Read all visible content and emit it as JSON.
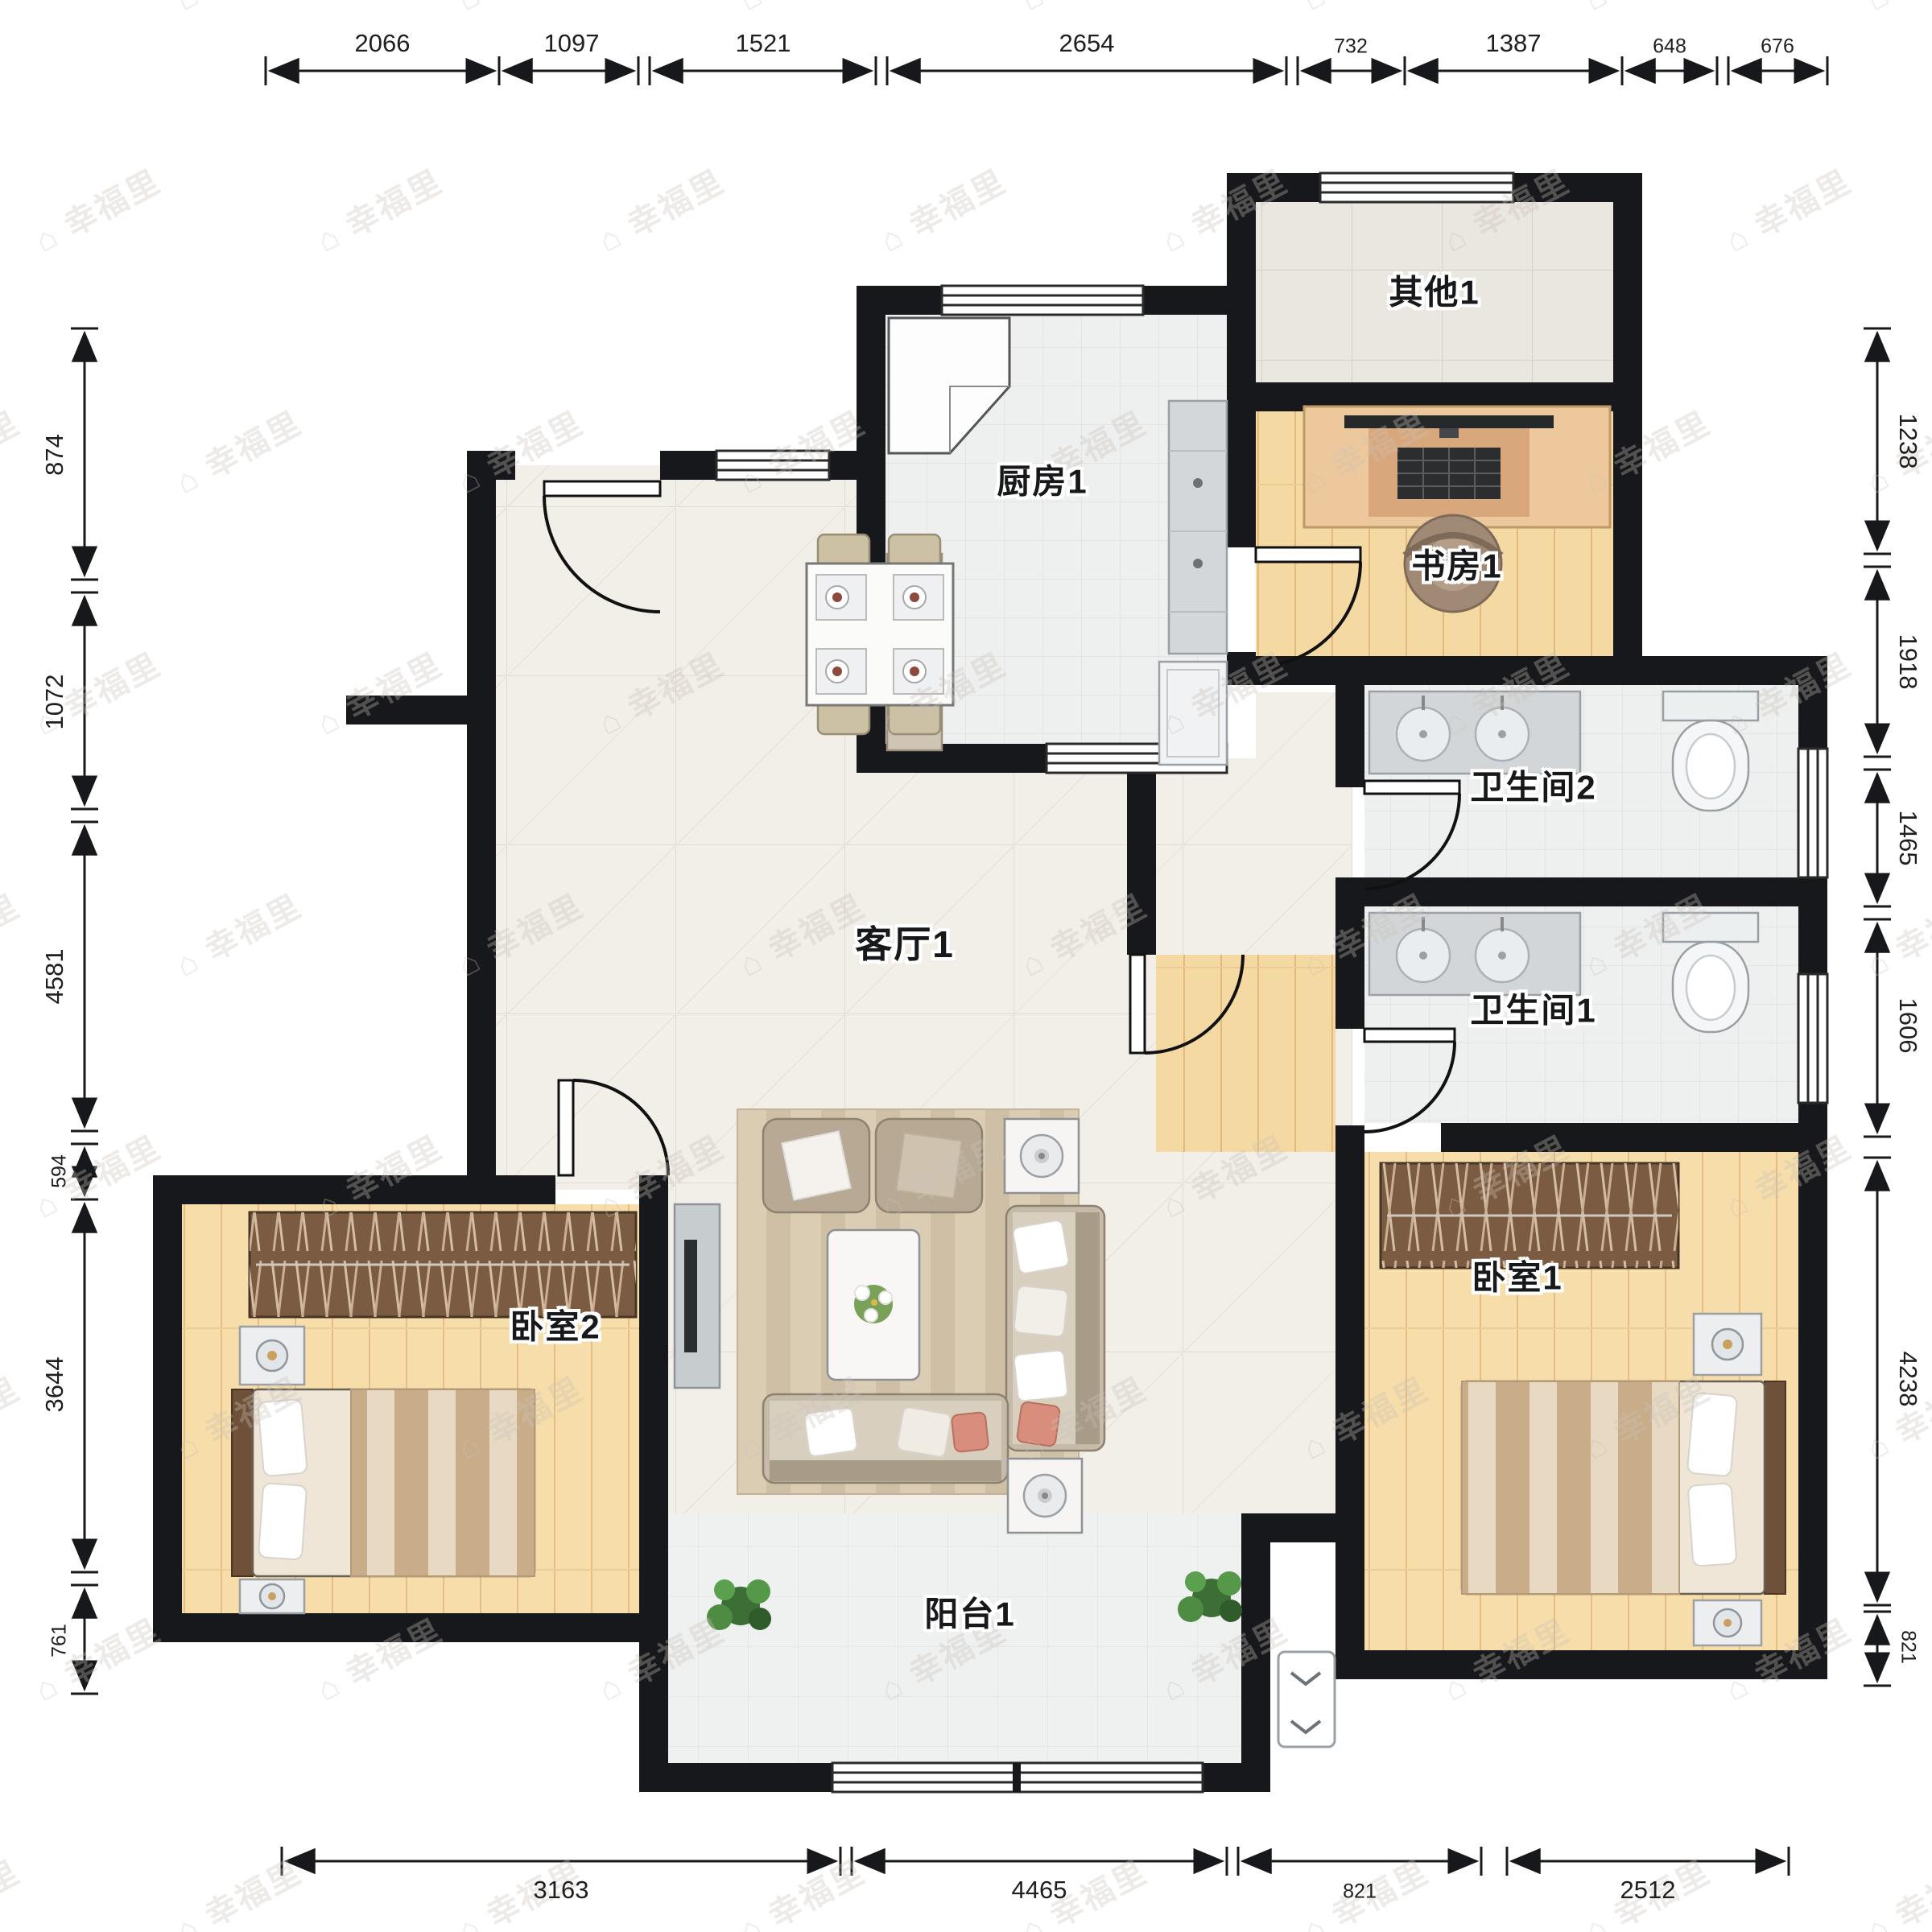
{
  "watermark": {
    "text": "幸福里",
    "icon": "house-icon"
  },
  "rooms": [
    {
      "id": "qita1",
      "label": "其他1"
    },
    {
      "id": "chufang1",
      "label": "厨房1"
    },
    {
      "id": "shufang1",
      "label": "书房1"
    },
    {
      "id": "weishengjian2",
      "label": "卫生间2"
    },
    {
      "id": "weishengjian1",
      "label": "卫生间1"
    },
    {
      "id": "keting1",
      "label": "客厅1"
    },
    {
      "id": "woshi2",
      "label": "卧室2"
    },
    {
      "id": "woshi1",
      "label": "卧室1"
    },
    {
      "id": "yangtai1",
      "label": "阳台1"
    }
  ],
  "dimensions": {
    "unit": "mm",
    "top": [
      "2066",
      "1097",
      "1521",
      "2654",
      "732",
      "1387",
      "648",
      "676"
    ],
    "left": [
      "874",
      "1072",
      "4581",
      "594",
      "3644",
      "761"
    ],
    "right": [
      "1238",
      "1918",
      "1465",
      "1606",
      "4238",
      "821"
    ],
    "bottom": [
      "3163",
      "4465",
      "821",
      "2512"
    ]
  },
  "colors": {
    "wall": "#16181b",
    "wood_floor": "#f5d9a2",
    "marble_floor": "#f2eee8",
    "tile_floor": "#eef0ef",
    "wardrobe": "#7b5b41",
    "sofa": "#c6baa8",
    "plant": "#4a8a42",
    "dimension_text": "#1f1f1f"
  }
}
